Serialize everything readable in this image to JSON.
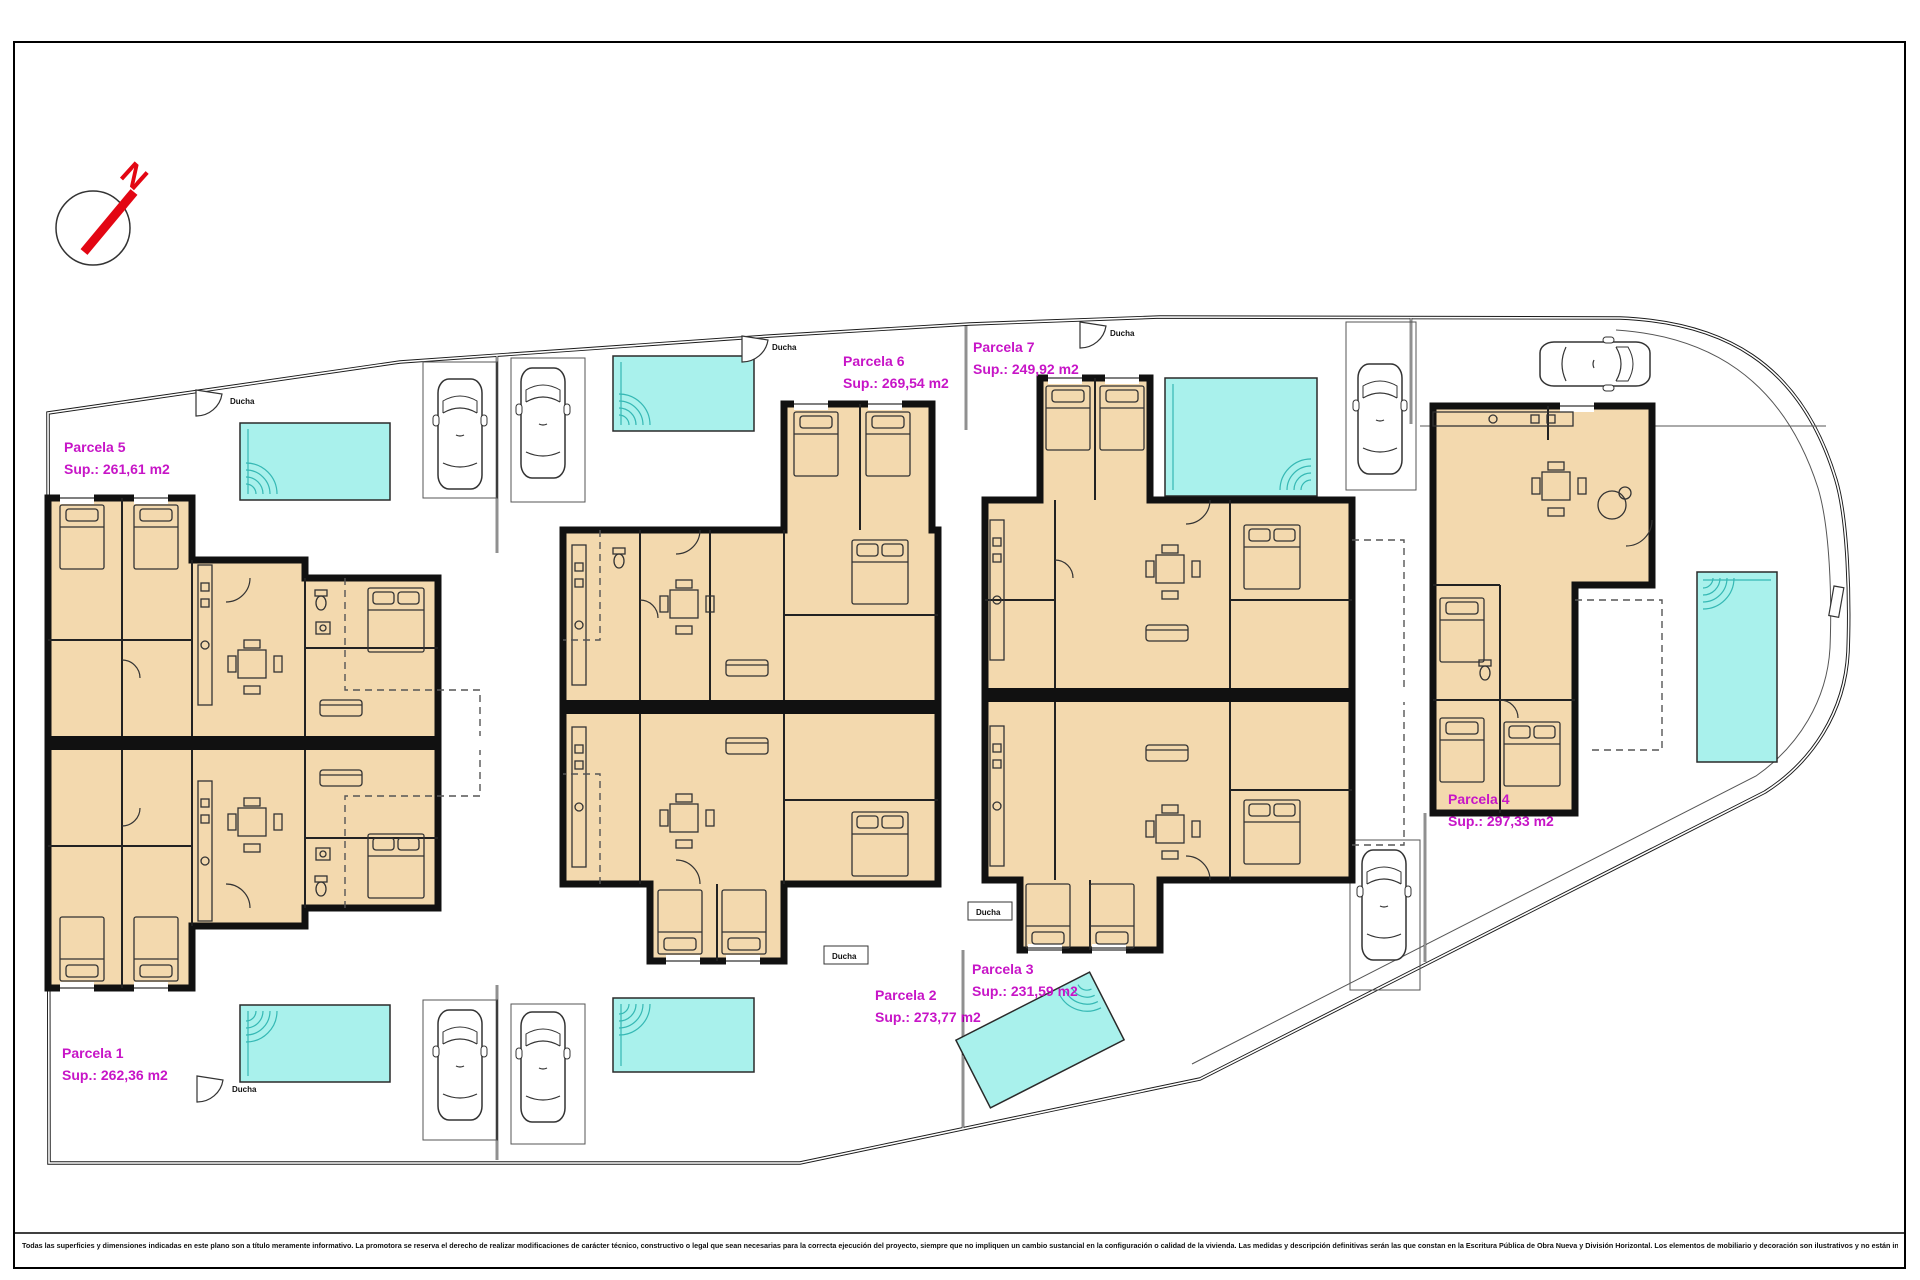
{
  "north": {
    "letter": "N"
  },
  "parcels": [
    {
      "id": "parcela-1",
      "name": "Parcela 1",
      "sup": "Sup.: 262,36 m2"
    },
    {
      "id": "parcela-2",
      "name": "Parcela 2",
      "sup": "Sup.: 273,77 m2"
    },
    {
      "id": "parcela-3",
      "name": "Parcela 3",
      "sup": "Sup.: 231,59 m2"
    },
    {
      "id": "parcela-4",
      "name": "Parcela 4",
      "sup": "Sup.: 297,33 m2"
    },
    {
      "id": "parcela-5",
      "name": "Parcela 5",
      "sup": "Sup.: 261,61 m2"
    },
    {
      "id": "parcela-6",
      "name": "Parcela 6",
      "sup": "Sup.: 269,54 m2"
    },
    {
      "id": "parcela-7",
      "name": "Parcela 7",
      "sup": "Sup.: 249,92 m2"
    }
  ],
  "labels": {
    "shower": "Ducha"
  },
  "disclaimer": "Todas las superficies y dimensiones indicadas en este plano son a título meramente informativo. La promotora se reserva el derecho de realizar modificaciones de carácter técnico, constructivo o legal que sean necesarias para la correcta ejecución del proyecto, siempre que no impliquen un cambio sustancial en la configuración o calidad de la vivienda. Las medidas y descripción definitivas serán las que constan en la Escritura Pública de Obra Nueva y División Horizontal. Los elementos de mobiliario y decoración son ilustrativos y no están incluidos.",
  "colors": {
    "room_fill": "#f3d9ae",
    "pool_fill": "#a9f1ec",
    "label_magenta": "#c715c7",
    "north_red": "#e30613",
    "wall_black": "#111111"
  }
}
